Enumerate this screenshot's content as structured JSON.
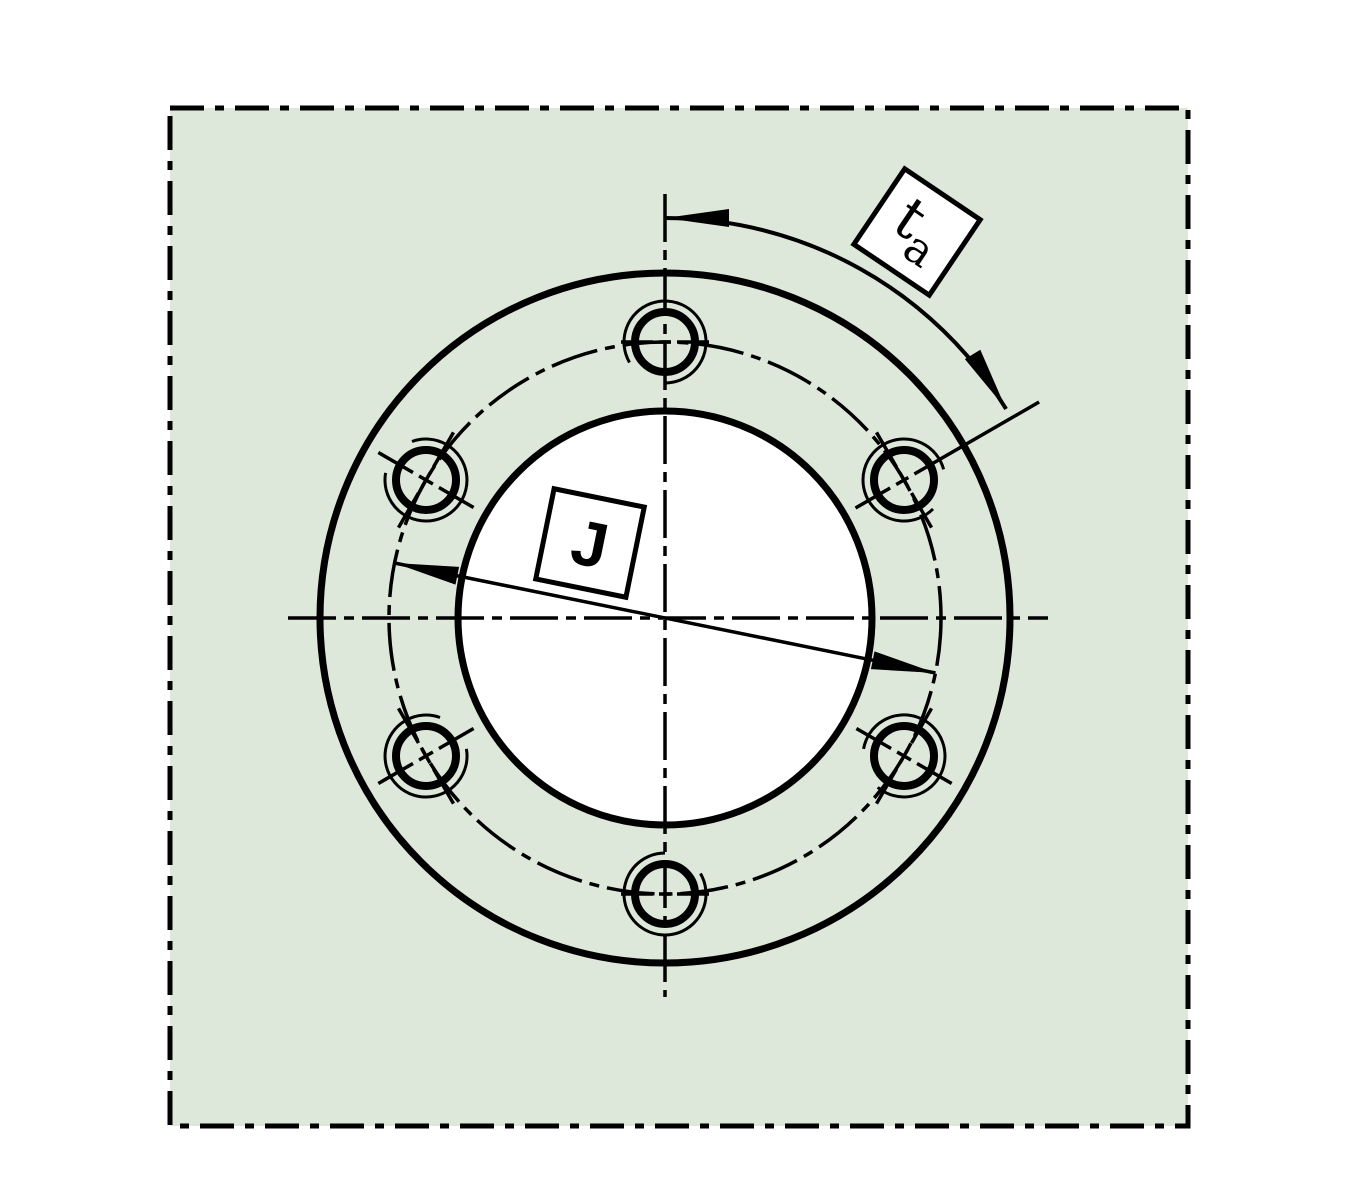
{
  "title": "Flange mounting drawing - bolt circle diameter J and hole pitch angle ta",
  "colors": {
    "page_background": "#ffffff",
    "panel_fill": "#dee8da",
    "line": "#000000",
    "label_box_fill": "#ffffff"
  },
  "labels": {
    "bolt_circle_diameter": "J",
    "pitch_angle_main": "t",
    "pitch_angle_sub": "a"
  },
  "diagram": {
    "canvas": {
      "width": 1350,
      "height": 1200
    },
    "panel": {
      "x": 170,
      "y": 108,
      "width": 1018,
      "height": 1018
    },
    "center": {
      "x": 665,
      "y": 618
    },
    "outer_circle_radius": 345,
    "bore_radius": 207,
    "bolt_circle_radius": 276,
    "bolt_hole_radius": 30,
    "thread_arc_radius": 41,
    "bolt_hole_count": 6,
    "bolt_holes": [
      {
        "angle_deg": 90,
        "thread_gap_deg": 240,
        "radial_line": false,
        "tangential_line": true
      },
      {
        "angle_deg": 150,
        "thread_gap_deg": 140,
        "radial_line": true,
        "tangential_line": true
      },
      {
        "angle_deg": 210,
        "thread_gap_deg": 40,
        "radial_line": true,
        "tangential_line": true
      },
      {
        "angle_deg": 270,
        "thread_gap_deg": 60,
        "radial_line": false,
        "tangential_line": true
      },
      {
        "angle_deg": 330,
        "thread_gap_deg": 200,
        "radial_line": true,
        "tangential_line": true
      },
      {
        "angle_deg": 30,
        "thread_gap_deg": 345,
        "radial_line": false,
        "tangential_line": true
      }
    ],
    "centerlines": {
      "vertical": {
        "x": 665,
        "y1": 194,
        "y2": 997
      },
      "horizontal": {
        "y": 618,
        "x1": 288,
        "x2": 1048
      }
    },
    "dim_j": {
      "angle_deg": -11.5,
      "label_box": {
        "cx": 590,
        "cy": 543,
        "side": 92,
        "rotation_deg": 11.5
      }
    },
    "dim_ta": {
      "arc_radius": 400,
      "start_angle_deg": 90,
      "end_angle_deg": 31.5,
      "extension_line": {
        "angle_deg": 30,
        "r_inner": 220,
        "r_outer": 432
      },
      "label_box": {
        "cx": 917,
        "cy": 232,
        "side": 91,
        "rotation_deg": 34
      }
    }
  }
}
